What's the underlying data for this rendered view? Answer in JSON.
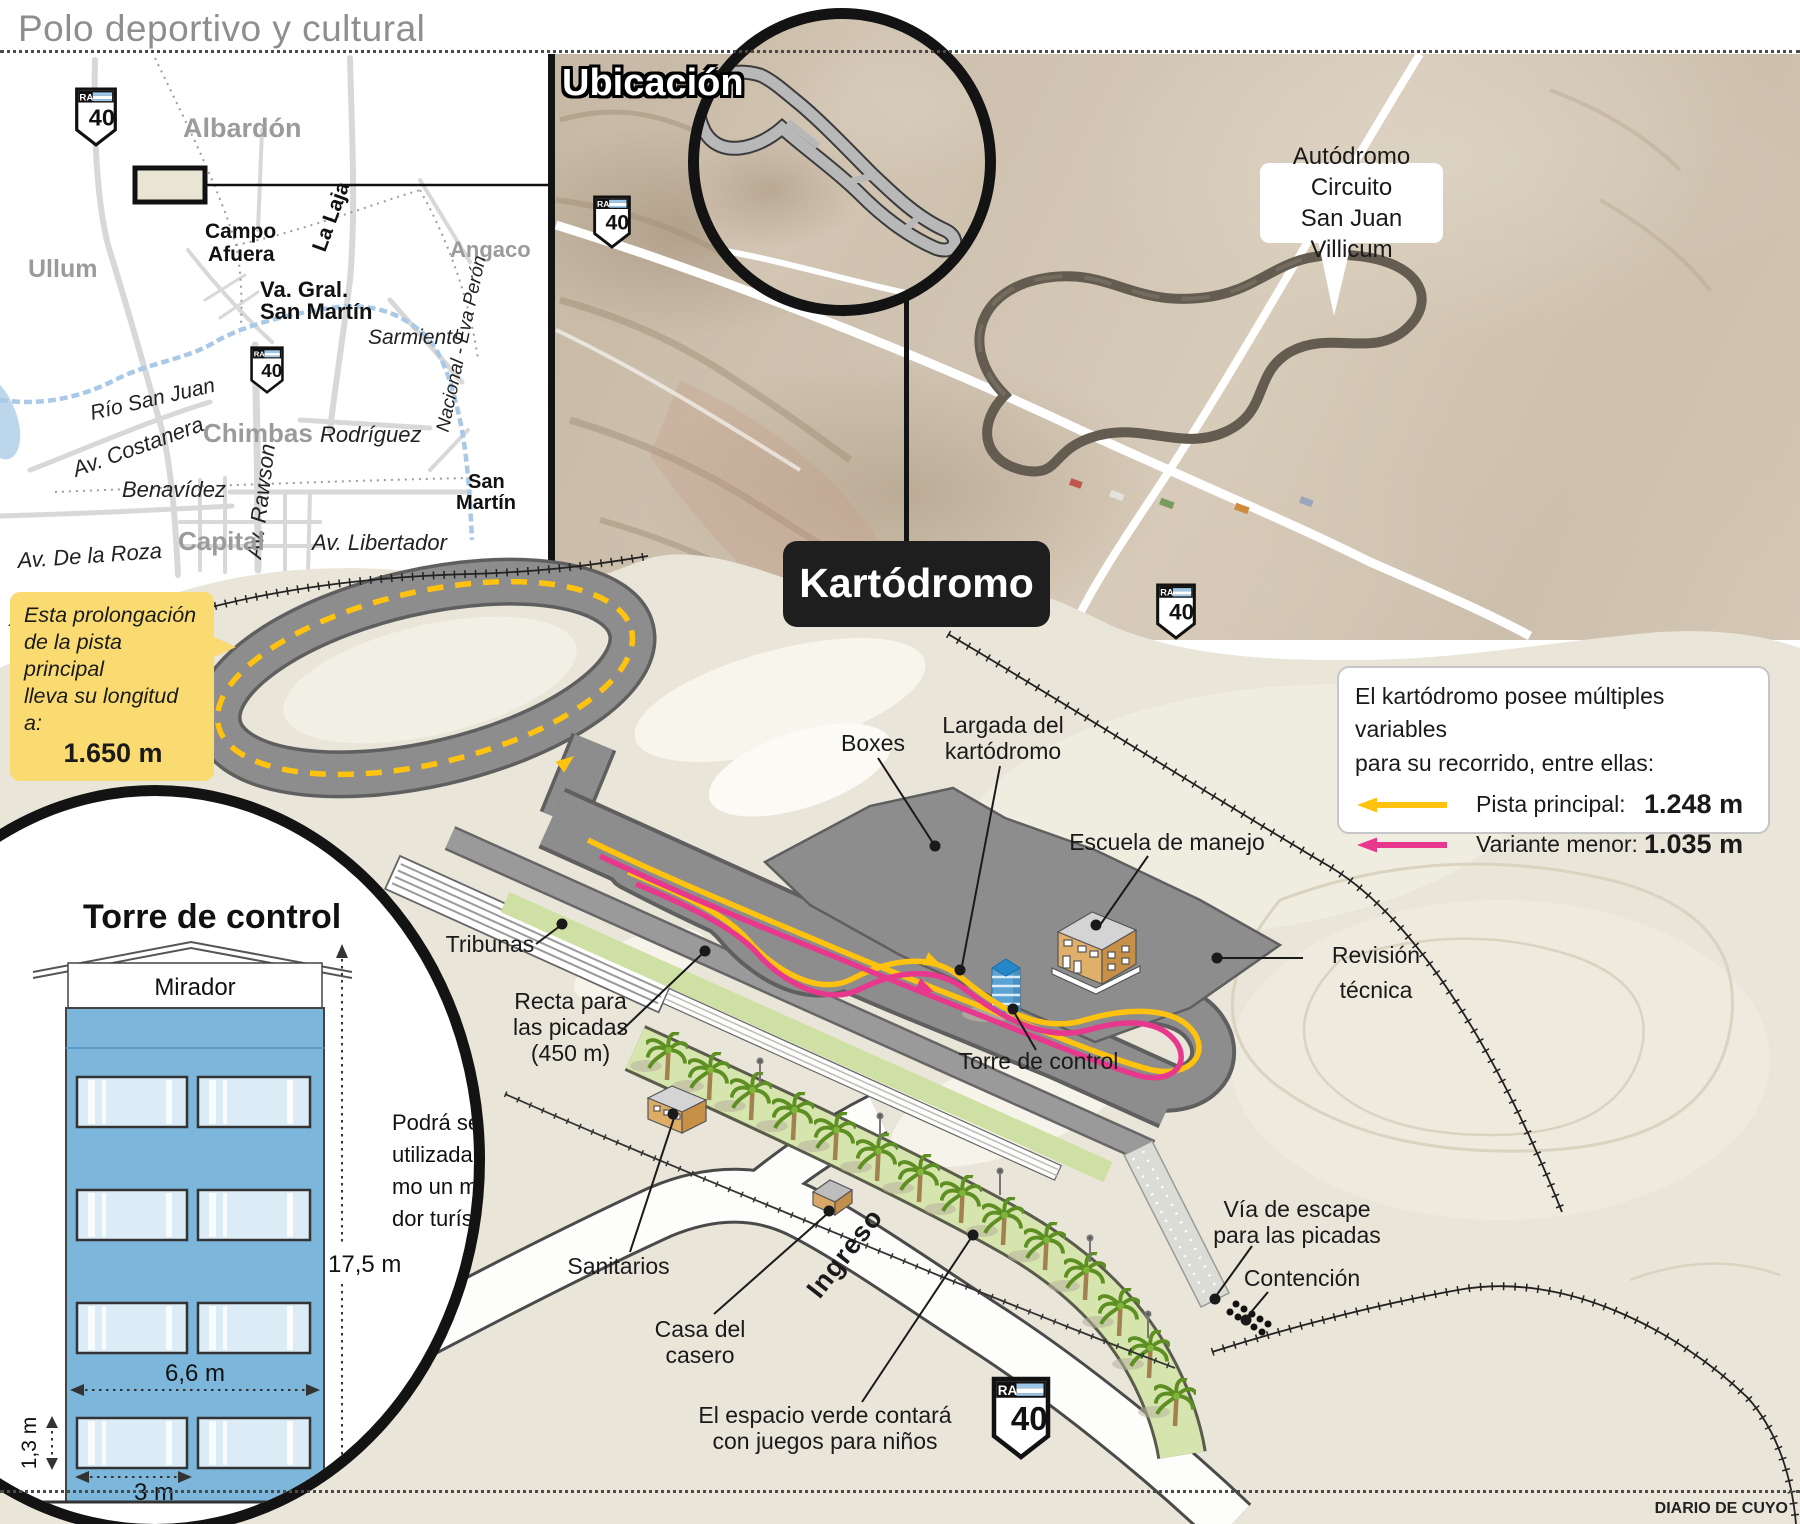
{
  "header": {
    "title": "Polo deportivo y cultural",
    "credit": "DIARIO DE CUYO"
  },
  "shield": {
    "prefix": "RA",
    "number": "40"
  },
  "map": {
    "albardon": "Albardón",
    "ullum": "Ullum",
    "angaco": "Angaco",
    "campo_afuera_1": "Campo",
    "campo_afuera_2": "Afuera",
    "la_laja": "La Laja",
    "va_gral_1": "Va. Gral.",
    "va_gral_2": "San Martín",
    "sarmiento": "Sarmiento",
    "nacional_eva_peron": "Nacional - Eva Perón",
    "rio_san_juan": "Río San Juan",
    "chimbas": "Chimbas",
    "rodriguez": "Rodríguez",
    "av_costanera": "Av. Costanera",
    "benavidez": "Benavídez",
    "av_rawson": "Av. Rawson",
    "san_martin_1": "San",
    "san_martin_2": "Martín",
    "capital": "Capital",
    "av_libertador": "Av. Libertador",
    "av_de_la_roza": "Av. De la Roza",
    "north": "N"
  },
  "satellite": {
    "section_title": "Ubicación",
    "autodromo_1": "Autódromo Circuito",
    "autodromo_2": "San Juan Villicum",
    "kartodromo": "Kartódromo"
  },
  "prolongacion": {
    "line1": "Esta prolongación",
    "line2": "de la pista principal",
    "line3": "lleva su longitud a:",
    "value": "1.650 m",
    "bg_color": "#FADB71"
  },
  "legend": {
    "intro_1": "El kartódromo posee múltiples variables",
    "intro_2": "para su recorrido, entre ellas:",
    "rows": [
      {
        "label": "Pista principal:",
        "value": "1.248 m",
        "color": "#FFC20E"
      },
      {
        "label": "Variante menor:",
        "value": "1.035 m",
        "color": "#E8388E"
      }
    ]
  },
  "diagram": {
    "boxes": "Boxes",
    "largada_1": "Largada del",
    "largada_2": "kartódromo",
    "escuela": "Escuela de manejo",
    "revision_1": "Revisión",
    "revision_2": "técnica",
    "tribunas": "Tribunas",
    "recta_1": "Recta para",
    "recta_2": "las picadas",
    "recta_3": "(450 m)",
    "torre": "Torre de control",
    "sanitarios": "Sanitarios",
    "casa_1": "Casa del",
    "casa_2": "casero",
    "ingreso": "Ingreso",
    "espacio_1": "El espacio verde contará",
    "espacio_2": "con juegos para niños",
    "via_1": "Vía de escape",
    "via_2": "para las picadas",
    "contencion": "Contención",
    "track_main_color": "#FFC20E",
    "track_variant_color": "#E8388E"
  },
  "tower": {
    "title": "Torre de control",
    "mirador": "Mirador",
    "height": "17,5 m",
    "width": "6,6 m",
    "window_height": "1,3 m",
    "window_width": "3 m",
    "note_1": "Podrá ser",
    "note_2": "utilizada co-",
    "note_3": "mo un mira-",
    "note_4": "dor turístico.",
    "body_color": "#7CB6DB"
  }
}
